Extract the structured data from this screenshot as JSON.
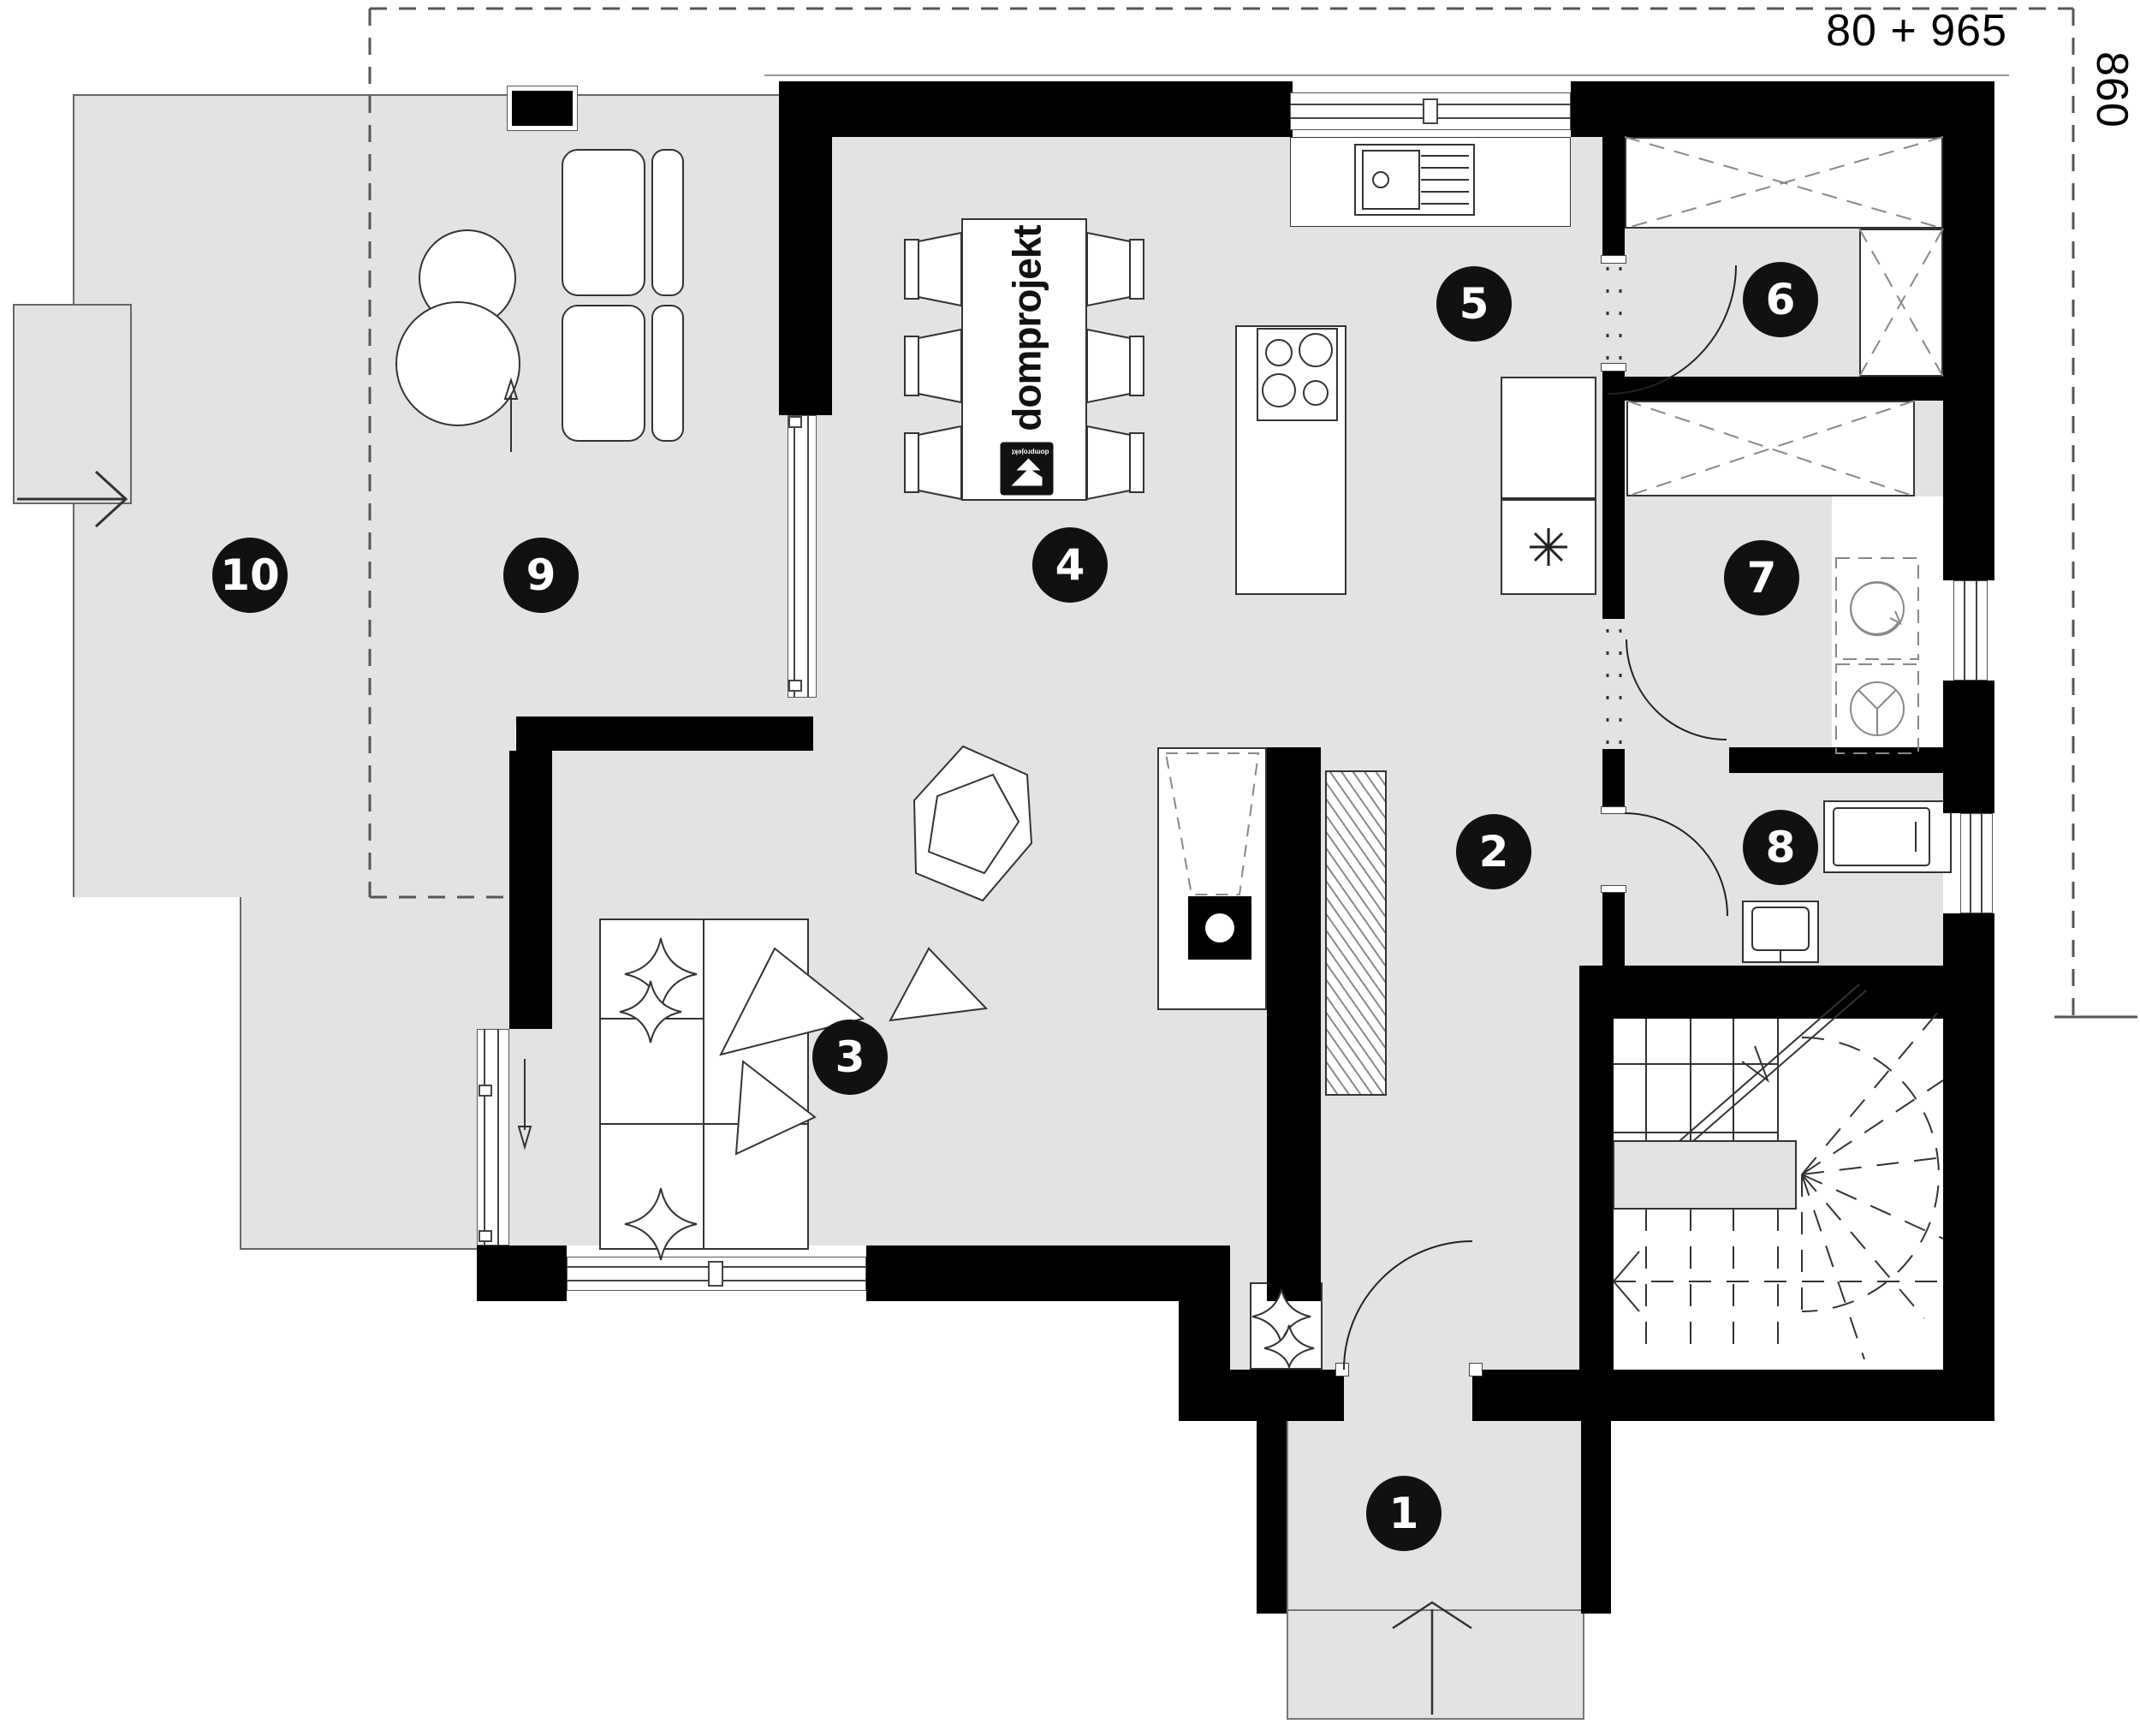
{
  "plan": {
    "dimension_labels": {
      "top": "80 + 965",
      "right": "860"
    },
    "brand": {
      "table_logo_text": "domprojekt",
      "logo_mark_text": "domprojekt"
    },
    "rooms": [
      {
        "number": "1"
      },
      {
        "number": "2"
      },
      {
        "number": "3"
      },
      {
        "number": "4"
      },
      {
        "number": "5"
      },
      {
        "number": "6"
      },
      {
        "number": "7"
      },
      {
        "number": "8"
      },
      {
        "number": "9"
      },
      {
        "number": "10"
      }
    ],
    "colors": {
      "floor_fill": "#e3e3e3",
      "wall_fill": "#000000",
      "badge_fill": "#111111",
      "dash_line": "#555555"
    },
    "icons": {
      "fridge_icon": "six-spoke-asterisk",
      "washer_icon": "circle-with-arrow",
      "dryer_icon": "circle-with-fan",
      "wardrobe_icon": "crossed-box",
      "entry_arrow_icon": "right-arrow",
      "door_swing_icon": "quarter-arc",
      "slide_arrow_icon": "line-arrow",
      "stair_direction_icon": "left-arrow"
    }
  }
}
